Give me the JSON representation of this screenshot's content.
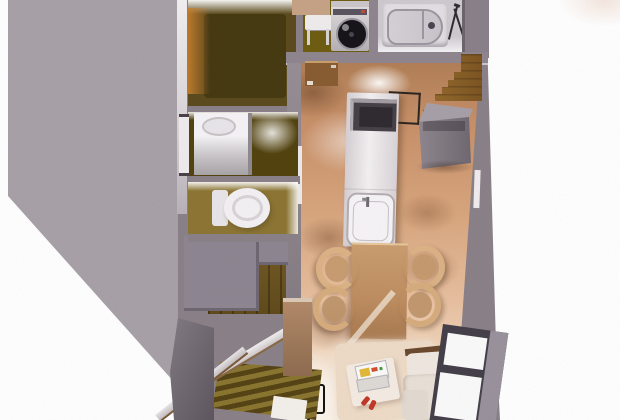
{
  "scene": {
    "description": "3D bird's-eye render of a narrow apartment floor plan",
    "background": "#ffffff",
    "corner_tint": "#f6eee8"
  },
  "palette": {
    "roof": "#a8a1a8",
    "wall": "#8b8289",
    "wallDark": "#6f676f",
    "wallDarker": "#5f575f",
    "wallLight": "#edeaec",
    "woodDark": "#5c4b1d",
    "oliveFloor": "#6e5d11",
    "washFloor": "#53430f",
    "toiletFloor": "#8d7634",
    "bathFloor": "#cfcad0",
    "kitchenWood": "#d09b73",
    "livingGlow": "#f6e7d4",
    "islandWhite": "#f2eff1",
    "counterGray": "#837b83",
    "counterGrayTop": "#a8a0a8",
    "stairsBrown": "#87602a",
    "stairsDark": "#6e5622",
    "tableTan": "#bf9164",
    "chairTan": "#dcb386",
    "rug": "#eedcc8",
    "sofa": "#ebe3da",
    "sofaWood": "#6b4a2e",
    "red": "#c23826",
    "laptopYellow": "#e2b93a",
    "black": "#1a1a1a",
    "tub": "#e3dfe4",
    "tubRim": "#9d97a0",
    "drum": "#17141a",
    "washerBody": "#d9d5d9",
    "windowFrame": "#45404a",
    "windowSill": "#9a929c",
    "paneWhite": "#fbfafa",
    "genkanLight": "#8a7630",
    "genkanDark": "#564416",
    "pillarBrown": "#b28a69",
    "landingGray": "#8e8691",
    "railWhite": "#ece8ea",
    "doorTrim": "#f1edef",
    "counterPink": "#c7a386",
    "cabinetBrown": "#8a5d33",
    "holeDark": "#3d3412",
    "glowOrange": "#cd822d"
  },
  "rooms": [
    {
      "name": "upper-hall",
      "floor": "#5c4b1d"
    },
    {
      "name": "laundry-utility",
      "floor": "#6e5d11"
    },
    {
      "name": "bathroom",
      "floor": "#cfcad0"
    },
    {
      "name": "washroom-vanity",
      "floor": "#53430f"
    },
    {
      "name": "toilet-room",
      "floor": "#8d7634"
    },
    {
      "name": "kitchen-dining-living",
      "floor": "#d09b73"
    },
    {
      "name": "entry-genkan",
      "floor": "#6e5622"
    }
  ],
  "fixtures": [
    {
      "name": "washing-machine"
    },
    {
      "name": "laundry-stool"
    },
    {
      "name": "bathtub"
    },
    {
      "name": "towel-rack"
    },
    {
      "name": "vanity-sink"
    },
    {
      "name": "toilet"
    },
    {
      "name": "kitchen-island-cooktop-sink"
    },
    {
      "name": "range-hood-outline"
    },
    {
      "name": "refrigerator-counter"
    },
    {
      "name": "upper-staircase"
    },
    {
      "name": "lower-staircase"
    },
    {
      "name": "dining-table"
    },
    {
      "name": "dining-chairs-x4"
    },
    {
      "name": "living-rug"
    },
    {
      "name": "low-table-with-laptop"
    },
    {
      "name": "red-slippers"
    },
    {
      "name": "l-shaped-sofa"
    },
    {
      "name": "balcony-window"
    },
    {
      "name": "entry-railings"
    },
    {
      "name": "genkan-slat-floor"
    },
    {
      "name": "glass-door-frame"
    }
  ]
}
